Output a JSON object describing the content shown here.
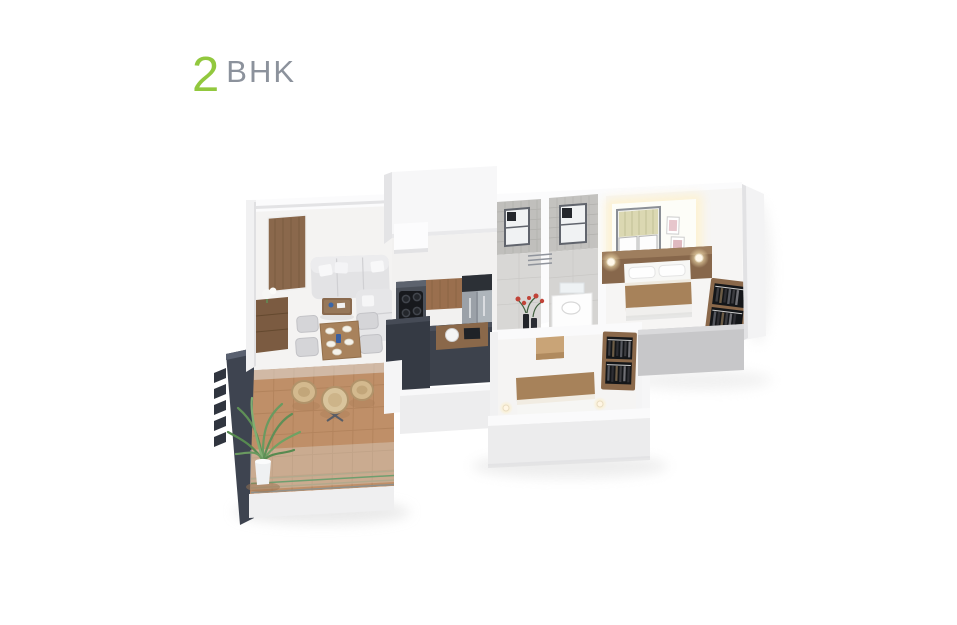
{
  "header": {
    "unit_count": "2",
    "unit_label": "BHK"
  },
  "theme": {
    "accent_green": "#92c83e",
    "heading_gray": "#8c929c",
    "page_background": "#ffffff"
  },
  "floorplan": {
    "view": "3d-isometric-apartment-render",
    "rooms": [
      "living-room",
      "dining-area",
      "kitchen",
      "bathroom-1",
      "bathroom-2",
      "wash-passage",
      "master-bedroom",
      "second-bedroom",
      "balcony"
    ],
    "features": [
      "entrance-door",
      "l-shaped-sofa",
      "coffee-table",
      "tv-unit",
      "dining-table-with-plates",
      "kitchen-counter-with-cooktop",
      "refrigerator",
      "bathroom-windows",
      "washbasin",
      "flower-vase",
      "master-bed",
      "open-wardrobes",
      "table-lamps",
      "bench",
      "balcony-table-and-chairs",
      "potted-plant",
      "glass-railing",
      "louver-feature-wall"
    ],
    "palette": {
      "wall_white": "#fbfbfc",
      "wall_shadow": "#c7c7c9",
      "charcoal": "#3e4450",
      "terracotta_floor": "#bf8f68",
      "wood": "#8a684a",
      "bed_linen_brown": "#a7825a",
      "sofa_gray": "#e3e3e5",
      "tile_gray": "#c0bfbc",
      "plant_green": "#61905a",
      "lamp_glow": "#fff3cf"
    }
  }
}
